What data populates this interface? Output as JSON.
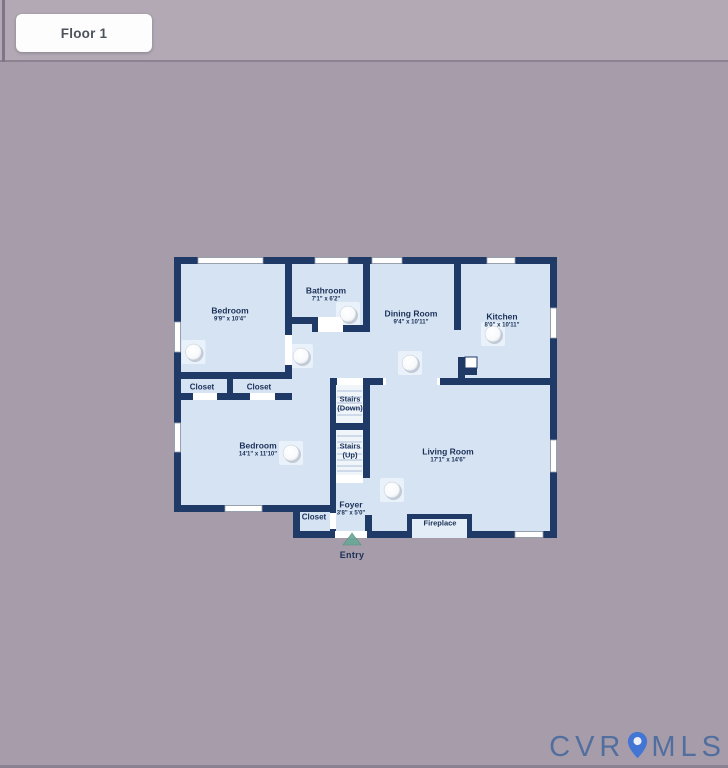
{
  "header": {
    "floor_label": "Floor 1"
  },
  "floorplan": {
    "rooms": [
      {
        "name": "Bedroom",
        "dims": "9'9\" x 10'4\""
      },
      {
        "name": "Bathroom",
        "dims": "7'1\" x 6'2\""
      },
      {
        "name": "Dining Room",
        "dims": "9'4\" x 10'11\""
      },
      {
        "name": "Kitchen",
        "dims": "8'0\" x 10'11\""
      },
      {
        "name": "Bedroom",
        "dims": "14'1\" x 11'10\""
      },
      {
        "name": "Living Room",
        "dims": "17'1\" x 14'6\""
      },
      {
        "name": "Foyer",
        "dims": "3'8\" x 5'0\""
      }
    ],
    "closets": [
      "Closet",
      "Closet",
      "Closet"
    ],
    "stairs": [
      {
        "line1": "Stairs",
        "line2": "(Down)"
      },
      {
        "line1": "Stairs",
        "line2": "(Up)"
      }
    ],
    "fireplace_label": "Fireplace",
    "entry_label": "Entry",
    "icons": [
      "ceiling-light-icon",
      "entry-arrow-icon",
      "window-marker",
      "door-opening"
    ],
    "colors": {
      "background": "#a79daa",
      "top_band": "#b2a9b5",
      "wall": "#203a68",
      "floor": "#d5e3f3",
      "label": "#1b3057",
      "entry_arrow": "#68a796",
      "watermark": "#4a6b9f"
    }
  },
  "watermark": {
    "left": "CVR",
    "right": "MLS",
    "pin_icon": "location-pin"
  }
}
